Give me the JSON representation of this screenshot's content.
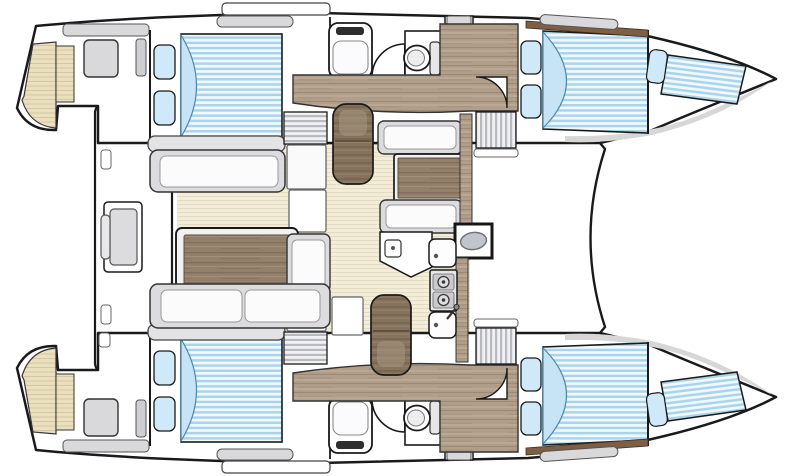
{
  "diagram": {
    "subject": "Catamaran interior layout floor plan, top-down view, bow pointing right",
    "orientation_bow": "right",
    "orientation_stern": "left",
    "symmetry": "twin hulls mirrored about horizontal centerline",
    "background": "#ffffff"
  },
  "palette": {
    "outline": "#1a1a1a",
    "mattress_stripe": "#a9d4ec",
    "mattress_bg": "#f2f9fd",
    "bedding_fold": "#c6e4f6",
    "pillow": "#cfe9f8",
    "wood": "#b19e8a",
    "wood_dark": "#85735d",
    "table_wood": "#93806b",
    "floor_cream": "#f2ecd9",
    "transom_beige": "#eae0bf",
    "upholstery_gray": "#dcdcde",
    "cushion_white": "#fbfbfb",
    "locker_gray": "#d9d9db",
    "hatch_stripe": "#b7bbc1",
    "deck_wood_brown": "#7d5f46",
    "appliance_black": "#161616",
    "steel_gray": "#bfc5cb",
    "bow_shade": "#d7d7d7"
  },
  "inventory": {
    "hulls": 2,
    "double_beds": 4,
    "forepeak_berths": 2,
    "pillows": 10,
    "heads_compartments": 2,
    "toilets": 2,
    "wash_basins": 2,
    "shower_doors": 2,
    "cabin_doors": 2,
    "galley_sinks": 3,
    "oval_basin_unit": 1,
    "stove_burners": 2,
    "saloon_sofas": 2,
    "saloon_table": 1,
    "dinette_table": 1,
    "wood_chairs": 2,
    "companionway_steps": 4,
    "cockpit_bench": 1,
    "transom_platforms": 2,
    "deck_hatches": 4,
    "storage_lockers": 6
  }
}
